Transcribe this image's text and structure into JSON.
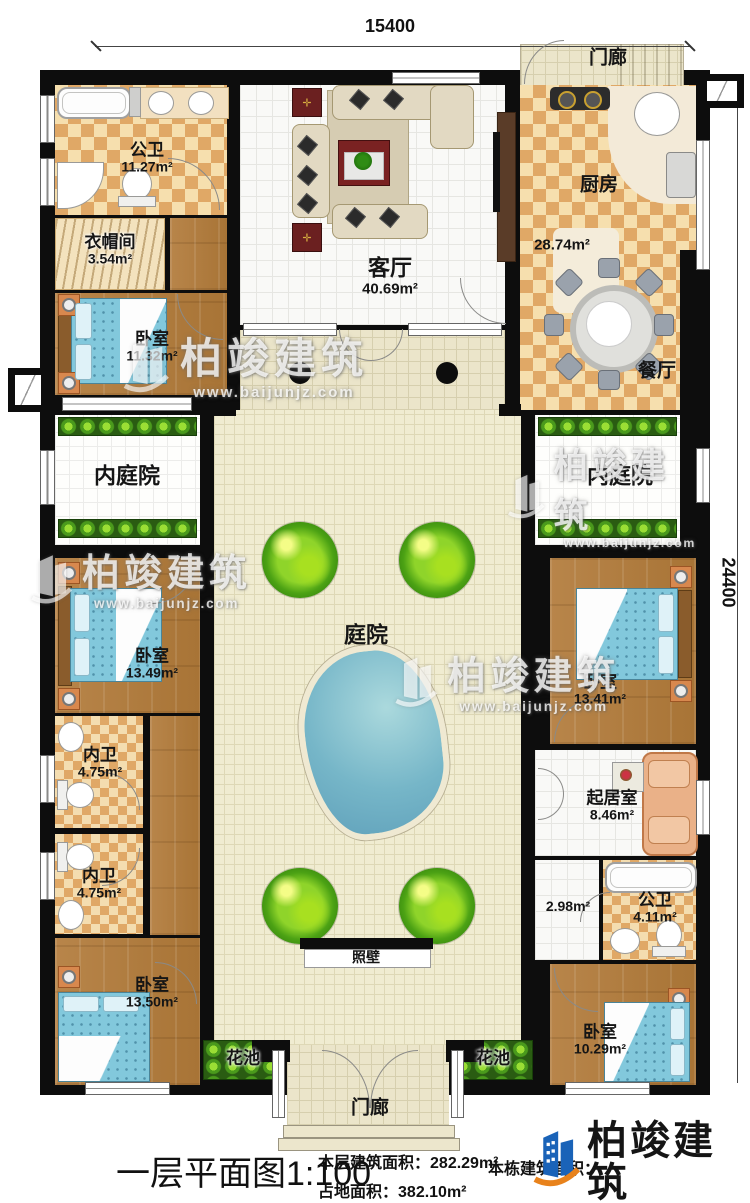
{
  "dimensions": {
    "top": "15400",
    "right": "24400"
  },
  "rooms": {
    "porch_top": {
      "name": "门廊"
    },
    "bath_top": {
      "name": "公卫",
      "area": "11.27m²"
    },
    "cloakroom": {
      "name": "衣帽间",
      "area": "3.54m²"
    },
    "bedroom_top_left": {
      "name": "卧室",
      "area": "11.32m²"
    },
    "living_room": {
      "name": "客厅",
      "area": "40.69m²"
    },
    "kitchen": {
      "name": "厨房",
      "area": "28.74m²"
    },
    "dining_room": {
      "name": "餐厅"
    },
    "inner_courtyard_left": {
      "name": "内庭院"
    },
    "inner_courtyard_right": {
      "name": "内庭院"
    },
    "courtyard": {
      "name": "庭院"
    },
    "bedroom_mid_left": {
      "name": "卧室",
      "area": "13.49m²"
    },
    "bedroom_mid_right": {
      "name": "卧室",
      "area": "13.41m²"
    },
    "inner_bath_1": {
      "name": "内卫",
      "area": "4.75m²"
    },
    "inner_bath_2": {
      "name": "内卫",
      "area": "4.75m²"
    },
    "sitting_room": {
      "name": "起居室",
      "area": "8.46m²"
    },
    "hallway": {
      "area": "2.98m²"
    },
    "bath_bottom_right": {
      "name": "公卫",
      "area": "4.11m²"
    },
    "bedroom_bottom_left": {
      "name": "卧室",
      "area": "13.50m²"
    },
    "bedroom_bottom_right": {
      "name": "卧室",
      "area": "10.29m²"
    },
    "screen_wall": {
      "name": "照壁"
    },
    "flower_bed_left": {
      "name": "花池"
    },
    "flower_bed_right": {
      "name": "花池"
    },
    "porch_bottom": {
      "name": "门廊"
    }
  },
  "footer": {
    "title": "一层平面图",
    "scale": "1:100",
    "floor_area_label": "本层建筑面积：",
    "floor_area_value": "282.29m²",
    "land_area_label": "占地面积：",
    "land_area_value": "382.10m²",
    "total_area_label": "本栋建筑面积：",
    "brand": "柏竣建筑",
    "website": "www.baijunjz.com"
  },
  "watermark": {
    "brand": "柏竣建筑",
    "website": "www.baijunjz.com"
  }
}
